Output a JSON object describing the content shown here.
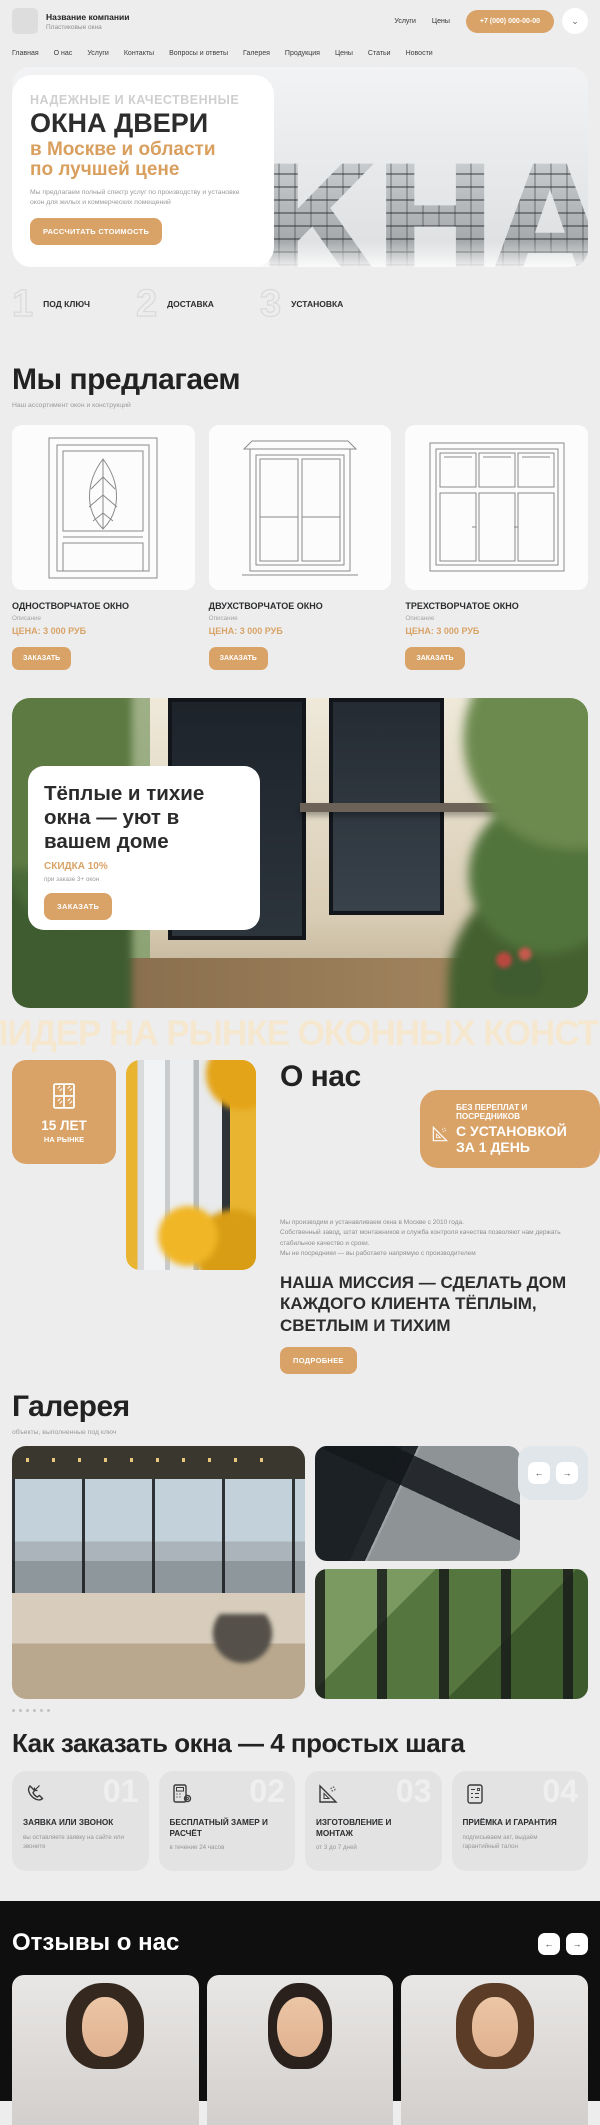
{
  "header": {
    "company_name": "Название компании",
    "tagline": "Пластиковые окна",
    "link_services": "Услуги",
    "link_prices": "Цены",
    "phone": "+7 (000) 000-00-00",
    "chevron": "⌄"
  },
  "nav": {
    "items": [
      "Главная",
      "О нас",
      "Услуги",
      "Контакты",
      "Вопросы и ответы",
      "Галерея",
      "Продукция",
      "Цены",
      "Статьи",
      "Новости"
    ]
  },
  "hero": {
    "kicker": "НАДЕЖНЫЕ И КАЧЕСТВЕННЫЕ",
    "title": "ОКНА ДВЕРИ",
    "subtitle_line1": "в Москве и области",
    "subtitle_line2": "по лучшей цене",
    "description": "Мы предлагаем полный спектр услуг по производству и установке окон для жилых и коммерческих помещений",
    "cta": "РАССЧИТАТЬ СТОИМОСТЬ",
    "bg_letters": "ОКНА"
  },
  "steps": {
    "items": [
      {
        "num": "1",
        "label": "ПОД КЛЮЧ"
      },
      {
        "num": "2",
        "label": "ДОСТАВКА"
      },
      {
        "num": "3",
        "label": "УСТАНОВКА"
      }
    ]
  },
  "offers": {
    "title": "Мы предлагаем",
    "subtitle": "Наш ассортимент окон и конструкций",
    "products": [
      {
        "name": "ОДНОСТВОРЧАТОЕ ОКНО",
        "desc": "Описание",
        "price": "ЦЕНА: 3 000 РУБ",
        "cta": "ЗАКАЗАТЬ"
      },
      {
        "name": "ДВУХСТВОРЧАТОЕ ОКНО",
        "desc": "Описание",
        "price": "ЦЕНА: 3 000 РУБ",
        "cta": "ЗАКАЗАТЬ"
      },
      {
        "name": "ТРЕХСТВОРЧАТОЕ ОКНО",
        "desc": "Описание",
        "price": "ЦЕНА: 3 000 РУБ",
        "cta": "ЗАКАЗАТЬ"
      }
    ]
  },
  "banner": {
    "title_line1": "Тёплые и тихие",
    "title_line2": "окна — уют в",
    "title_line3": "вашем доме",
    "discount": "СКИДКА 10%",
    "condition": "при заказе 3+ окон",
    "cta": "ЗАКАЗАТЬ"
  },
  "marquee": {
    "text": "ЛИДЕР НА РЫНКЕ ОКОННЫХ КОНСТРУКЦИЙ"
  },
  "about": {
    "title": "О нас",
    "years_value": "15 ЛЕТ",
    "years_label": "НА РЫНКЕ",
    "ribbon_line1": "БЕЗ ПЕРЕПЛАТ И ПОСРЕДНИКОВ",
    "ribbon_line2": "С УСТАНОВКОЙ",
    "ribbon_line3": "ЗА 1 ДЕНЬ",
    "paragraph_line1": "Мы производим и устанавливаем окна в Москве с 2010 года.",
    "paragraph_line2": "Собственный завод, штат монтажников и служба контроля качества позволяют нам держать стабильное качество и сроки.",
    "paragraph_line3": "Мы не посредники — вы работаете напрямую с производителем",
    "mission": "НАША МИССИЯ — СДЕЛАТЬ ДОМ КАЖДОГО КЛИЕНТА ТЁПЛЫМ, СВЕТЛЫМ И ТИХИМ",
    "cta": "ПОДРОБНЕЕ"
  },
  "gallery": {
    "title": "Галерея",
    "subtitle": "объекты, выполненные под ключ",
    "prev": "←",
    "next": "→"
  },
  "how": {
    "title": "Как заказать окна — 4 простых шага",
    "steps": [
      {
        "num": "01",
        "title": "ЗАЯВКА ИЛИ ЗВОНОК",
        "desc": "вы оставляете заявку на сайте или звоните"
      },
      {
        "num": "02",
        "title": "БЕСПЛАТНЫЙ ЗАМЕР И РАСЧЁТ",
        "desc": "в течение 24 часов"
      },
      {
        "num": "03",
        "title": "ИЗГОТОВЛЕНИЕ И МОНТАЖ",
        "desc": "от 3 до 7 дней"
      },
      {
        "num": "04",
        "title": "ПРИЁМКА И ГАРАНТИЯ",
        "desc": "подписываем акт, выдаём гарантийный талон"
      }
    ]
  },
  "reviews": {
    "title": "Отзывы о нас",
    "prev": "←",
    "next": "→"
  },
  "colors": {
    "accent": "#d9a368",
    "accent_light": "#f6e7cf",
    "dark_text": "#2b2d2e",
    "page_bg": "#ededee",
    "reviews_bg": "#0f0f0f"
  }
}
